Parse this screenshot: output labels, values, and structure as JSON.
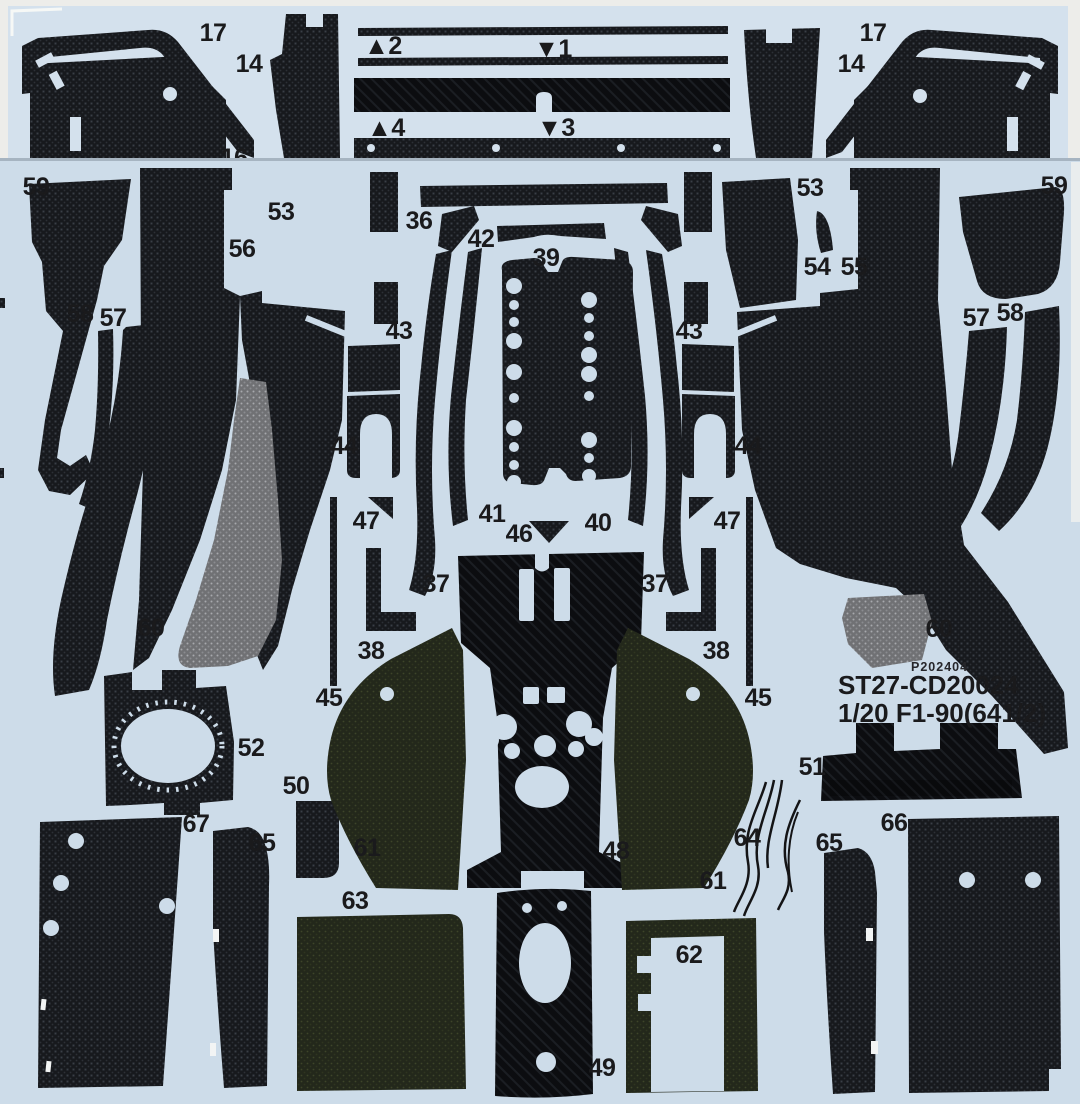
{
  "scan": {
    "print_code": "P202404",
    "product_code": "ST27-CD20024",
    "scale_model": "1/20 F1-90(641/2)",
    "top_sheet_labels": [
      {
        "text": "17",
        "x": 213,
        "y": 41
      },
      {
        "text": "14",
        "x": 249,
        "y": 72
      },
      {
        "text": "▲2",
        "x": 383,
        "y": 54
      },
      {
        "text": "▼1",
        "x": 553,
        "y": 57
      },
      {
        "text": "▲4",
        "x": 386,
        "y": 136
      },
      {
        "text": "▼3",
        "x": 556,
        "y": 136
      },
      {
        "text": "16",
        "x": 234,
        "y": 166
      },
      {
        "text": "14",
        "x": 851,
        "y": 72
      },
      {
        "text": "17",
        "x": 873,
        "y": 41
      }
    ],
    "main_sheet_labels": [
      {
        "text": "59",
        "x": 36,
        "y": 195
      },
      {
        "text": "53",
        "x": 281,
        "y": 220
      },
      {
        "text": "36",
        "x": 419,
        "y": 229
      },
      {
        "text": "42",
        "x": 481,
        "y": 247
      },
      {
        "text": "39",
        "x": 546,
        "y": 266
      },
      {
        "text": "53",
        "x": 810,
        "y": 196
      },
      {
        "text": "59",
        "x": 1054,
        "y": 194
      },
      {
        "text": "56",
        "x": 242,
        "y": 257
      },
      {
        "text": "54",
        "x": 817,
        "y": 275
      },
      {
        "text": "55",
        "x": 854,
        "y": 275
      },
      {
        "text": "58",
        "x": 80,
        "y": 322
      },
      {
        "text": "57",
        "x": 113,
        "y": 326
      },
      {
        "text": "57",
        "x": 976,
        "y": 326
      },
      {
        "text": "58",
        "x": 1010,
        "y": 321
      },
      {
        "text": "43",
        "x": 399,
        "y": 339
      },
      {
        "text": "43",
        "x": 689,
        "y": 339
      },
      {
        "text": "44",
        "x": 344,
        "y": 454
      },
      {
        "text": "44",
        "x": 748,
        "y": 454
      },
      {
        "text": "47",
        "x": 366,
        "y": 529
      },
      {
        "text": "47",
        "x": 727,
        "y": 529
      },
      {
        "text": "41",
        "x": 492,
        "y": 522
      },
      {
        "text": "46",
        "x": 519,
        "y": 542
      },
      {
        "text": "40",
        "x": 598,
        "y": 531
      },
      {
        "text": "37",
        "x": 436,
        "y": 592
      },
      {
        "text": "37",
        "x": 655,
        "y": 592
      },
      {
        "text": "38",
        "x": 371,
        "y": 659
      },
      {
        "text": "38",
        "x": 716,
        "y": 659
      },
      {
        "text": "45",
        "x": 329,
        "y": 706
      },
      {
        "text": "45",
        "x": 758,
        "y": 706
      },
      {
        "text": "60",
        "x": 151,
        "y": 636
      },
      {
        "text": "60",
        "x": 939,
        "y": 637
      },
      {
        "text": "52",
        "x": 251,
        "y": 756
      },
      {
        "text": "50",
        "x": 296,
        "y": 794
      },
      {
        "text": "51",
        "x": 812,
        "y": 775
      },
      {
        "text": "67",
        "x": 196,
        "y": 832
      },
      {
        "text": "65",
        "x": 262,
        "y": 851
      },
      {
        "text": "61",
        "x": 367,
        "y": 856
      },
      {
        "text": "63",
        "x": 355,
        "y": 909
      },
      {
        "text": "64",
        "x": 747,
        "y": 846
      },
      {
        "text": "65",
        "x": 829,
        "y": 851
      },
      {
        "text": "66",
        "x": 894,
        "y": 831
      },
      {
        "text": "61",
        "x": 713,
        "y": 889
      },
      {
        "text": "48",
        "x": 616,
        "y": 859
      },
      {
        "text": "62",
        "x": 689,
        "y": 963
      },
      {
        "text": "49",
        "x": 602,
        "y": 1076
      }
    ],
    "colors": {
      "backing_sheet_top": "#d4e1ed",
      "backing_sheet_bottom": "#cddce9",
      "carbon_black": "#17191d",
      "carbon_gray": "#6f7073",
      "carbon_olive": "#23281b",
      "label_text": "#1a1a1c"
    }
  }
}
